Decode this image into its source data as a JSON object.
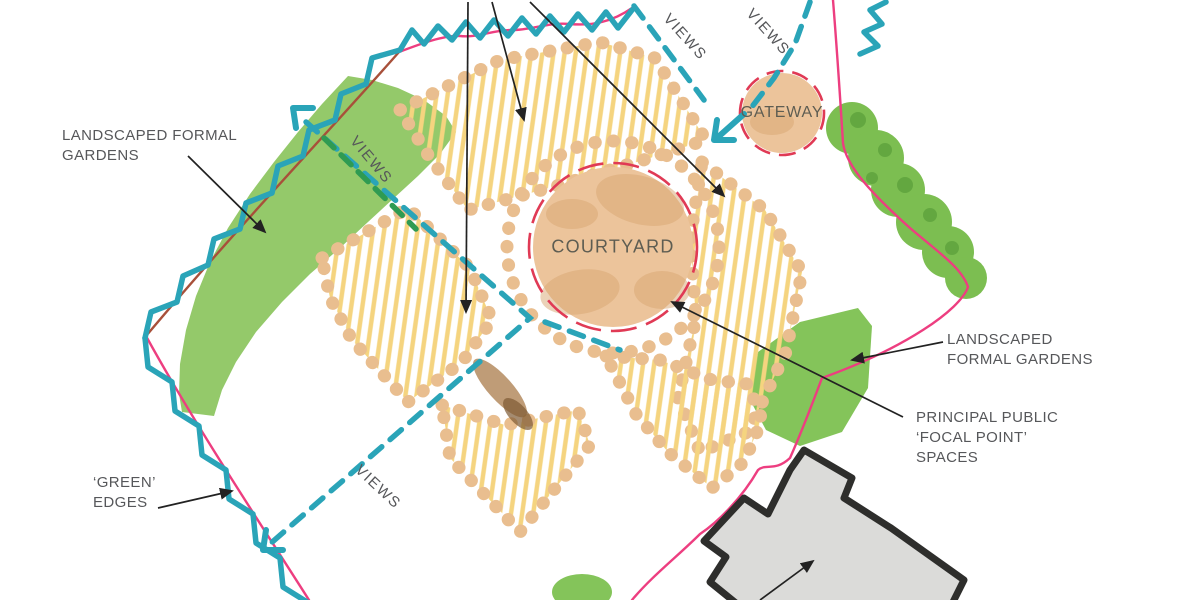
{
  "labels": {
    "landscaped_left": {
      "line1": "LANDSCAPED FORMAL",
      "line2": "GARDENS"
    },
    "green_edges": {
      "line1": "‘GREEN’",
      "line2": "EDGES"
    },
    "landscaped_right": {
      "line1": "LANDSCAPED",
      "line2": "FORMAL GARDENS"
    },
    "principal_public": {
      "line1": "PRINCIPAL PUBLIC",
      "line2": "‘FOCAL POINT’",
      "line3": "SPACES"
    },
    "courtyard": "COURTYARD",
    "gateway": "GATEWAY",
    "views": "VIEWS"
  },
  "colors": {
    "teal": "#2AA4B8",
    "pink": "#ED3E80",
    "brownline": "#A8503A",
    "reddash": "#E03A55",
    "band": "#94C96A",
    "hedge": "#7CBE51",
    "hedge_dark": "#569B38",
    "patch": "#84C45A",
    "hatch": "#F5D47F",
    "tan": "#E9BE8F",
    "court": "#ECC49B",
    "court_shadow": "#D8A671",
    "smudge": "#A97B4A",
    "smudge_dark": "#7E5A33",
    "building": "#DBDBD9",
    "outline": "#2E2E2C",
    "text": "#56575A",
    "text_plan": "#5E5D52",
    "black": "#222222",
    "green_dash": "#2F9B52"
  }
}
